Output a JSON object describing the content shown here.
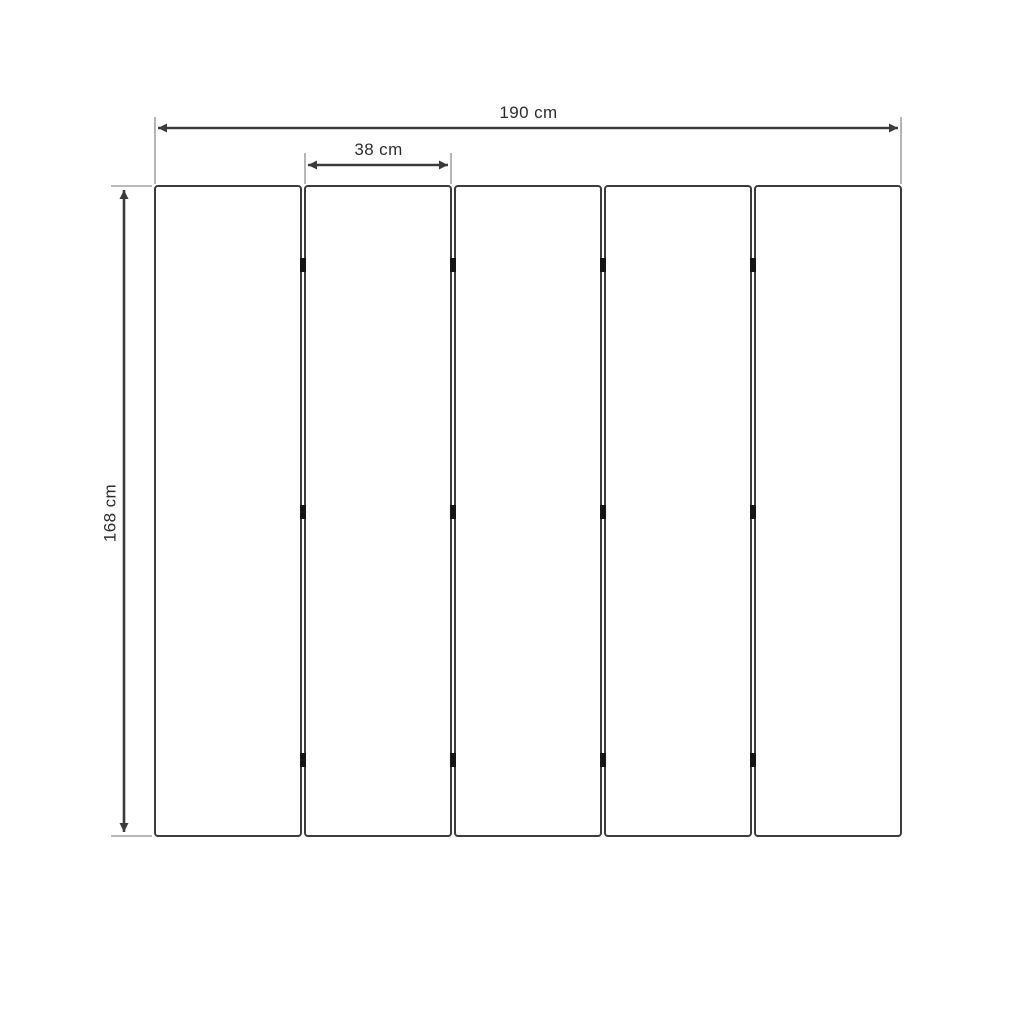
{
  "diagram": {
    "type": "technical-dimension-drawing",
    "labels": {
      "total_width": "190 cm",
      "panel_width": "38 cm",
      "total_height": "168 cm"
    },
    "panels": {
      "count": 5,
      "gaps": 4,
      "hinges_per_gap": 3
    },
    "colors": {
      "background": "#ffffff",
      "dimension_line": "#3a3a3a",
      "extension_line": "#a3a3a3",
      "panel_border": "#3c3c3c",
      "panel_fill": "#ffffff",
      "hinge": "#151515",
      "label_text": "#2d2d2d"
    }
  }
}
